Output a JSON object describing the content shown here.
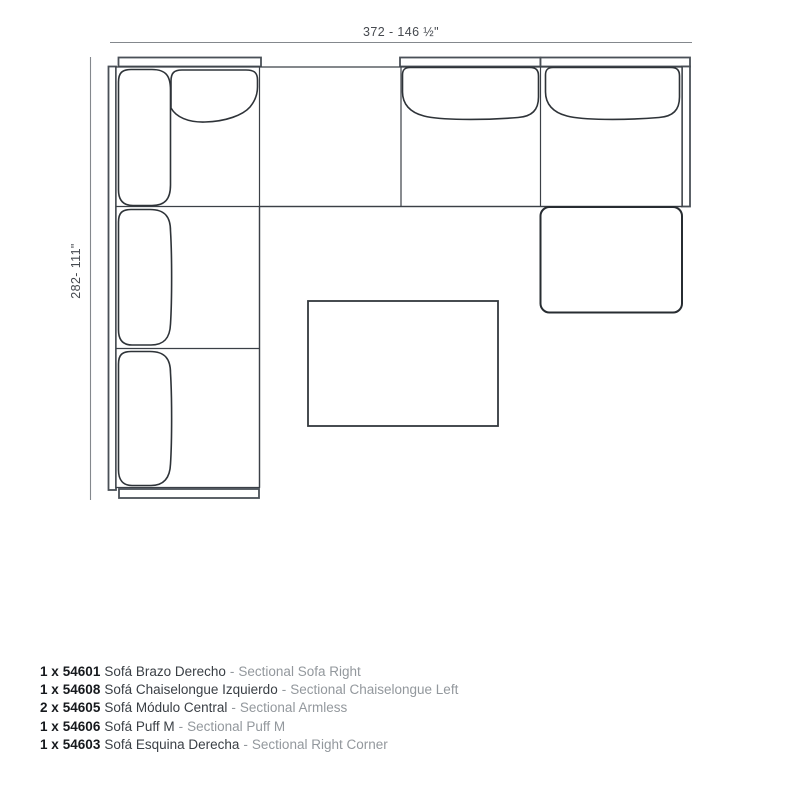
{
  "diagram": {
    "dimensions": {
      "width_label": "372 - 146 ½\"",
      "height_label": "282- 111\""
    },
    "colors": {
      "outline": "#3b4047",
      "cushion_line": "#2e3338",
      "frame_line": "#4a5057",
      "dimension_line": "#84888d",
      "dimension_text": "#45494f"
    }
  },
  "parts": {
    "items": [
      {
        "qty": "1 x",
        "code": "54601",
        "name_es": "Sofá Brazo Derecho",
        "sep": "-",
        "name_en": "Sectional Sofa Right"
      },
      {
        "qty": "1 x",
        "code": "54608",
        "name_es": "Sofá Chaiselongue Izquierdo",
        "sep": "-",
        "name_en": "Sectional Chaiselongue Left"
      },
      {
        "qty": "2 x",
        "code": "54605",
        "name_es": "Sofá Módulo Central",
        "sep": "-",
        "name_en": "Sectional Armless"
      },
      {
        "qty": "1 x",
        "code": "54606",
        "name_es": "Sofá Puff M",
        "sep": "-",
        "name_en": "Sectional Puff M"
      },
      {
        "qty": "1 x",
        "code": "54603",
        "name_es": "Sofá Esquina Derecha",
        "sep": "-",
        "name_en": "Sectional Right Corner"
      }
    ]
  }
}
